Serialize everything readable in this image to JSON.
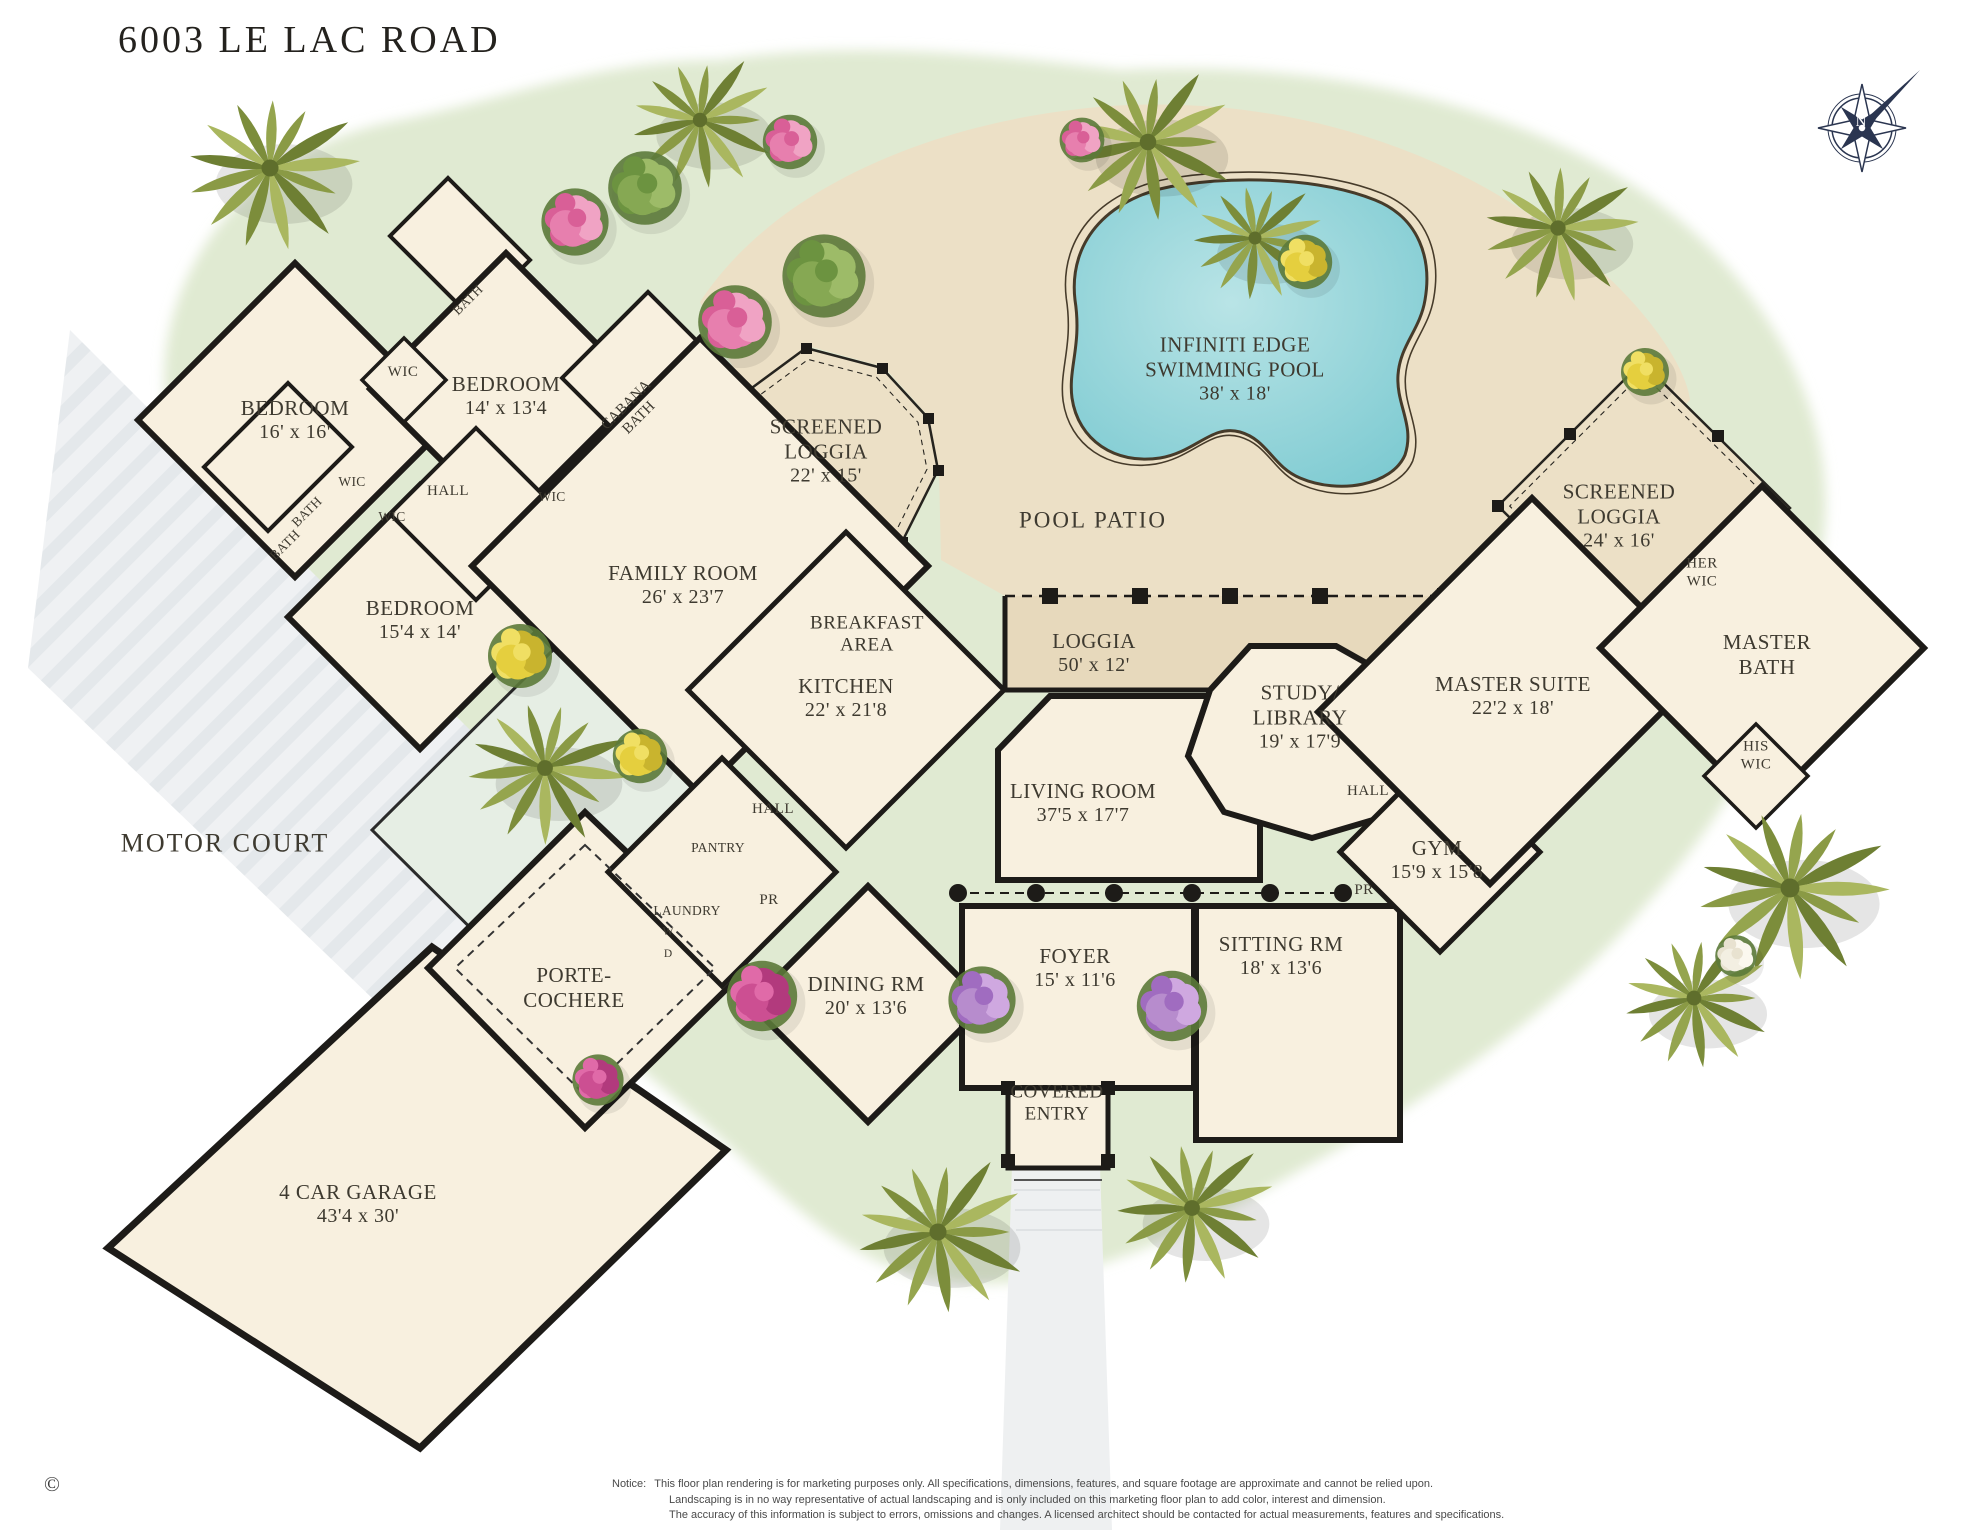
{
  "title": "6003 LE LAC ROAD",
  "copyright": "©",
  "compass": {
    "north": "N"
  },
  "colors": {
    "wall": "#1d1b18",
    "house_floor": "#f8f0df",
    "patio": "#ece0c6",
    "loggia": "#e7d9bc",
    "pool_water": "#8ed2d8",
    "landscape_green": "#e0ead2",
    "motor_court_gray": "#eff1f3",
    "label_text": "#3e3a30",
    "compass_navy": "#2a3550"
  },
  "rooms": {
    "br16": {
      "name": "BEDROOM",
      "dims": "16' x 16'"
    },
    "br14": {
      "name": "BEDROOM",
      "dims": "14' x 13'4"
    },
    "br15": {
      "name": "BEDROOM",
      "dims": "15'4 x 14'"
    },
    "family": {
      "name": "FAMILY ROOM",
      "dims": "26' x 23'7"
    },
    "sl1": {
      "l1": "SCREENED",
      "l2": "LOGGIA",
      "dims": "22' x 15'"
    },
    "pool": {
      "l1": "INFINITI EDGE",
      "l2": "SWIMMING POOL",
      "dims": "38' x 18'"
    },
    "pool_patio": {
      "name": "POOL PATIO"
    },
    "sl2": {
      "l1": "SCREENED",
      "l2": "LOGGIA",
      "dims": "24' x 16'"
    },
    "loggia": {
      "name": "LOGGIA",
      "dims": "50' x 12'"
    },
    "breakfast": {
      "l1": "BREAKFAST",
      "l2": "AREA"
    },
    "kitchen": {
      "name": "KITCHEN",
      "dims": "22' x 21'8"
    },
    "study": {
      "l1": "STUDY/",
      "l2": "LIBRARY",
      "dims": "19' x 17'9"
    },
    "living": {
      "name": "LIVING ROOM",
      "dims": "37'5 x 17'7"
    },
    "master": {
      "name": "MASTER SUITE",
      "dims": "22'2 x 18'"
    },
    "master_bath": {
      "l1": "MASTER",
      "l2": "BATH"
    },
    "her_wic": {
      "l1": "HER",
      "l2": "WIC"
    },
    "his_wic": {
      "l1": "HIS",
      "l2": "WIC"
    },
    "gym": {
      "name": "GYM",
      "dims": "15'9 x 15'8"
    },
    "sitting": {
      "name": "SITTING RM",
      "dims": "18' x 13'6"
    },
    "foyer": {
      "name": "FOYER",
      "dims": "15' x 11'6"
    },
    "dining": {
      "name": "DINING RM",
      "dims": "20' x 13'6"
    },
    "covered_entry": {
      "l1": "COVERED",
      "l2": "ENTRY"
    },
    "porte": {
      "l1": "PORTE-",
      "l2": "COCHERE"
    },
    "garage": {
      "name": "4 CAR GARAGE",
      "dims": "43'4 x 30'"
    },
    "motor_court": {
      "name": "MOTOR COURT"
    },
    "cabana": {
      "l1": "CABANA",
      "l2": "BATH"
    }
  },
  "labels": {
    "hall": "HALL",
    "wic": "WIC",
    "bath": "BATH",
    "pantry": "PANTRY",
    "laundry": "LAUNDRY",
    "powder_room": "PR",
    "washer": "W",
    "dryer": "D"
  },
  "notice": {
    "prefix": "Notice:",
    "lines": [
      "This floor plan rendering is for marketing purposes only. All specifications, dimensions, features, and square footage are approximate and cannot be relied upon.",
      "Landscaping is in no way representative of actual landscaping and is only included on this marketing floor plan to add color, interest and dimension.",
      "The accuracy of this information is subject to errors, omissions and changes. A licensed architect should be contacted for actual measurements, features and specifications."
    ]
  }
}
